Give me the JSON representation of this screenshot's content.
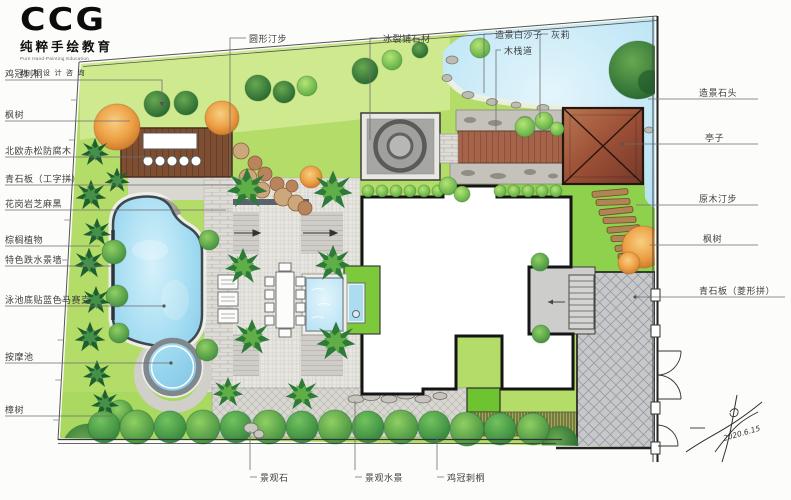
{
  "logo": {
    "brand": "CCG",
    "title_cn": "纯粹手绘教育",
    "title_en": "Pure Hand-Painting Education",
    "slogan": "助力设计咨询"
  },
  "labels": {
    "left": [
      "鸡冠刺桐",
      "枫树",
      "北欧赤松防腐木",
      "青石板（工字拼）",
      "花岗岩芝麻黑",
      "棕榈植物",
      "特色跌水景墙",
      "泳池底贴蓝色马赛克",
      "按摩池",
      "樟树"
    ],
    "top": [
      "圆形汀步",
      "冰裂铺石材",
      "造景白沙子",
      "木栈道",
      "灰莉"
    ],
    "right": [
      "造景石头",
      "亭子",
      "原木汀步",
      "枫树",
      "青石板（菱形拼）"
    ],
    "bottom": [
      "景观石",
      "景观水景",
      "鸡冠刺桐"
    ]
  },
  "signature": {
    "date": "2020.6.15"
  },
  "colors": {
    "lawn": "#b4dc68",
    "lawn_bright": "#8ed14c",
    "pool": "#9ed8ef",
    "roof": "#9c5036",
    "deck": "#7e4f33",
    "paving": "#d9d8d2",
    "diamond_paving": "#c7c8ca"
  }
}
